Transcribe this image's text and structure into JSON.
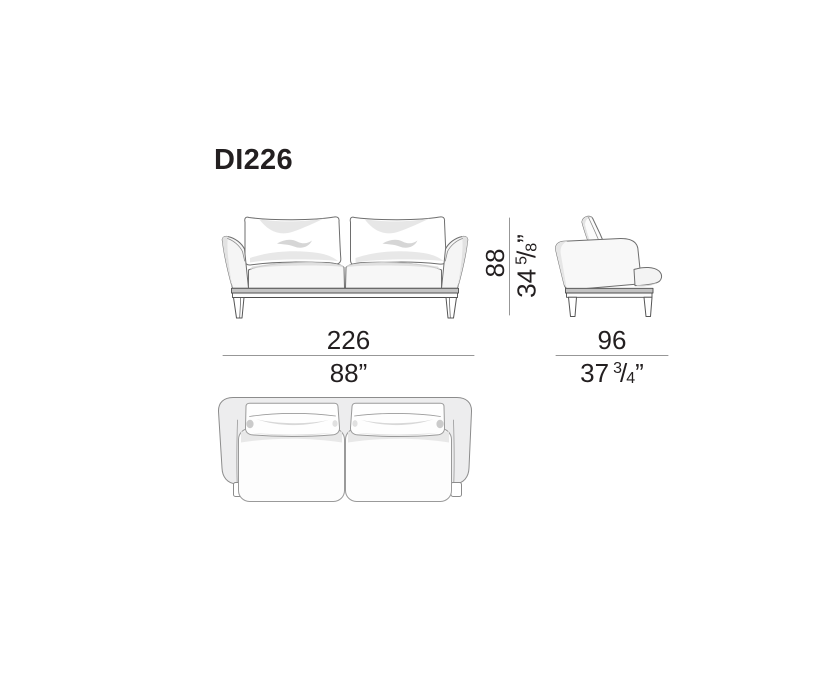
{
  "title": "DI226",
  "dimensions": {
    "width": {
      "cm": "226",
      "in": "88”"
    },
    "depth": {
      "cm": "96",
      "in_whole": "37",
      "in_num": "3",
      "in_den": "4",
      "in_unit": "”"
    },
    "height": {
      "cm": "88",
      "in_whole": "34",
      "in_num": "5",
      "in_den": "8",
      "in_unit": "”"
    }
  },
  "colors": {
    "ink": "#231f20",
    "outline": "#6e6e6e",
    "dim_line": "#979797",
    "frame_fill": "#ededee",
    "rail_fill": "#c3c3c3",
    "shade": "#dcdcdc",
    "background": "#ffffff"
  }
}
